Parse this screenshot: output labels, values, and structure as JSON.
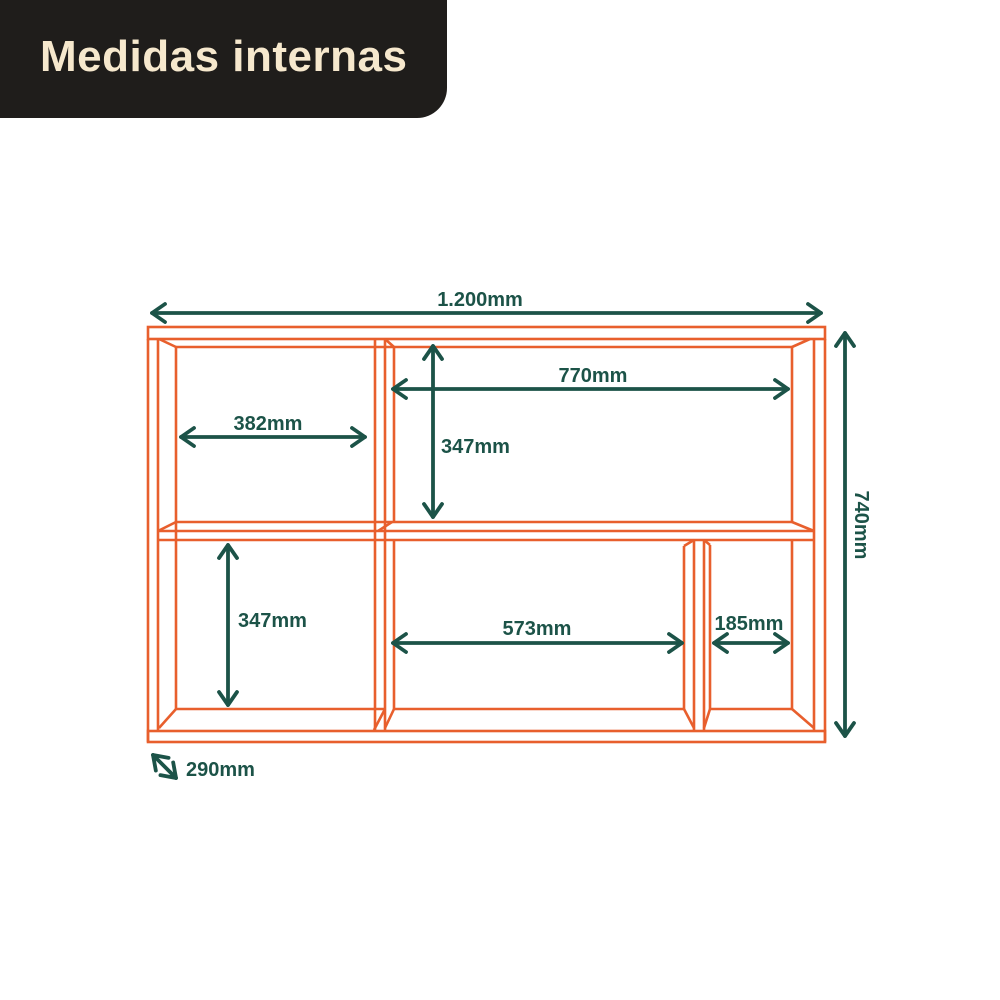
{
  "header": {
    "title": "Medidas internas"
  },
  "colors": {
    "header_background": "#1F1D1B",
    "header_text": "#F6E8CD",
    "furniture_outline": "#E85F2D",
    "dimension_annotations": "#1C5348",
    "background": "#FFFFFF"
  },
  "diagram": {
    "subject": "shelf-internal-measurements",
    "unit": "mm",
    "dimensions": {
      "total_width": "1.200mm",
      "total_height": "740mm",
      "depth": "290mm",
      "top_left_width": "382mm",
      "top_right_width": "770mm",
      "top_right_height": "347mm",
      "bottom_left_height": "347mm",
      "bottom_middle_width": "573mm",
      "bottom_right_width": "185mm"
    }
  }
}
